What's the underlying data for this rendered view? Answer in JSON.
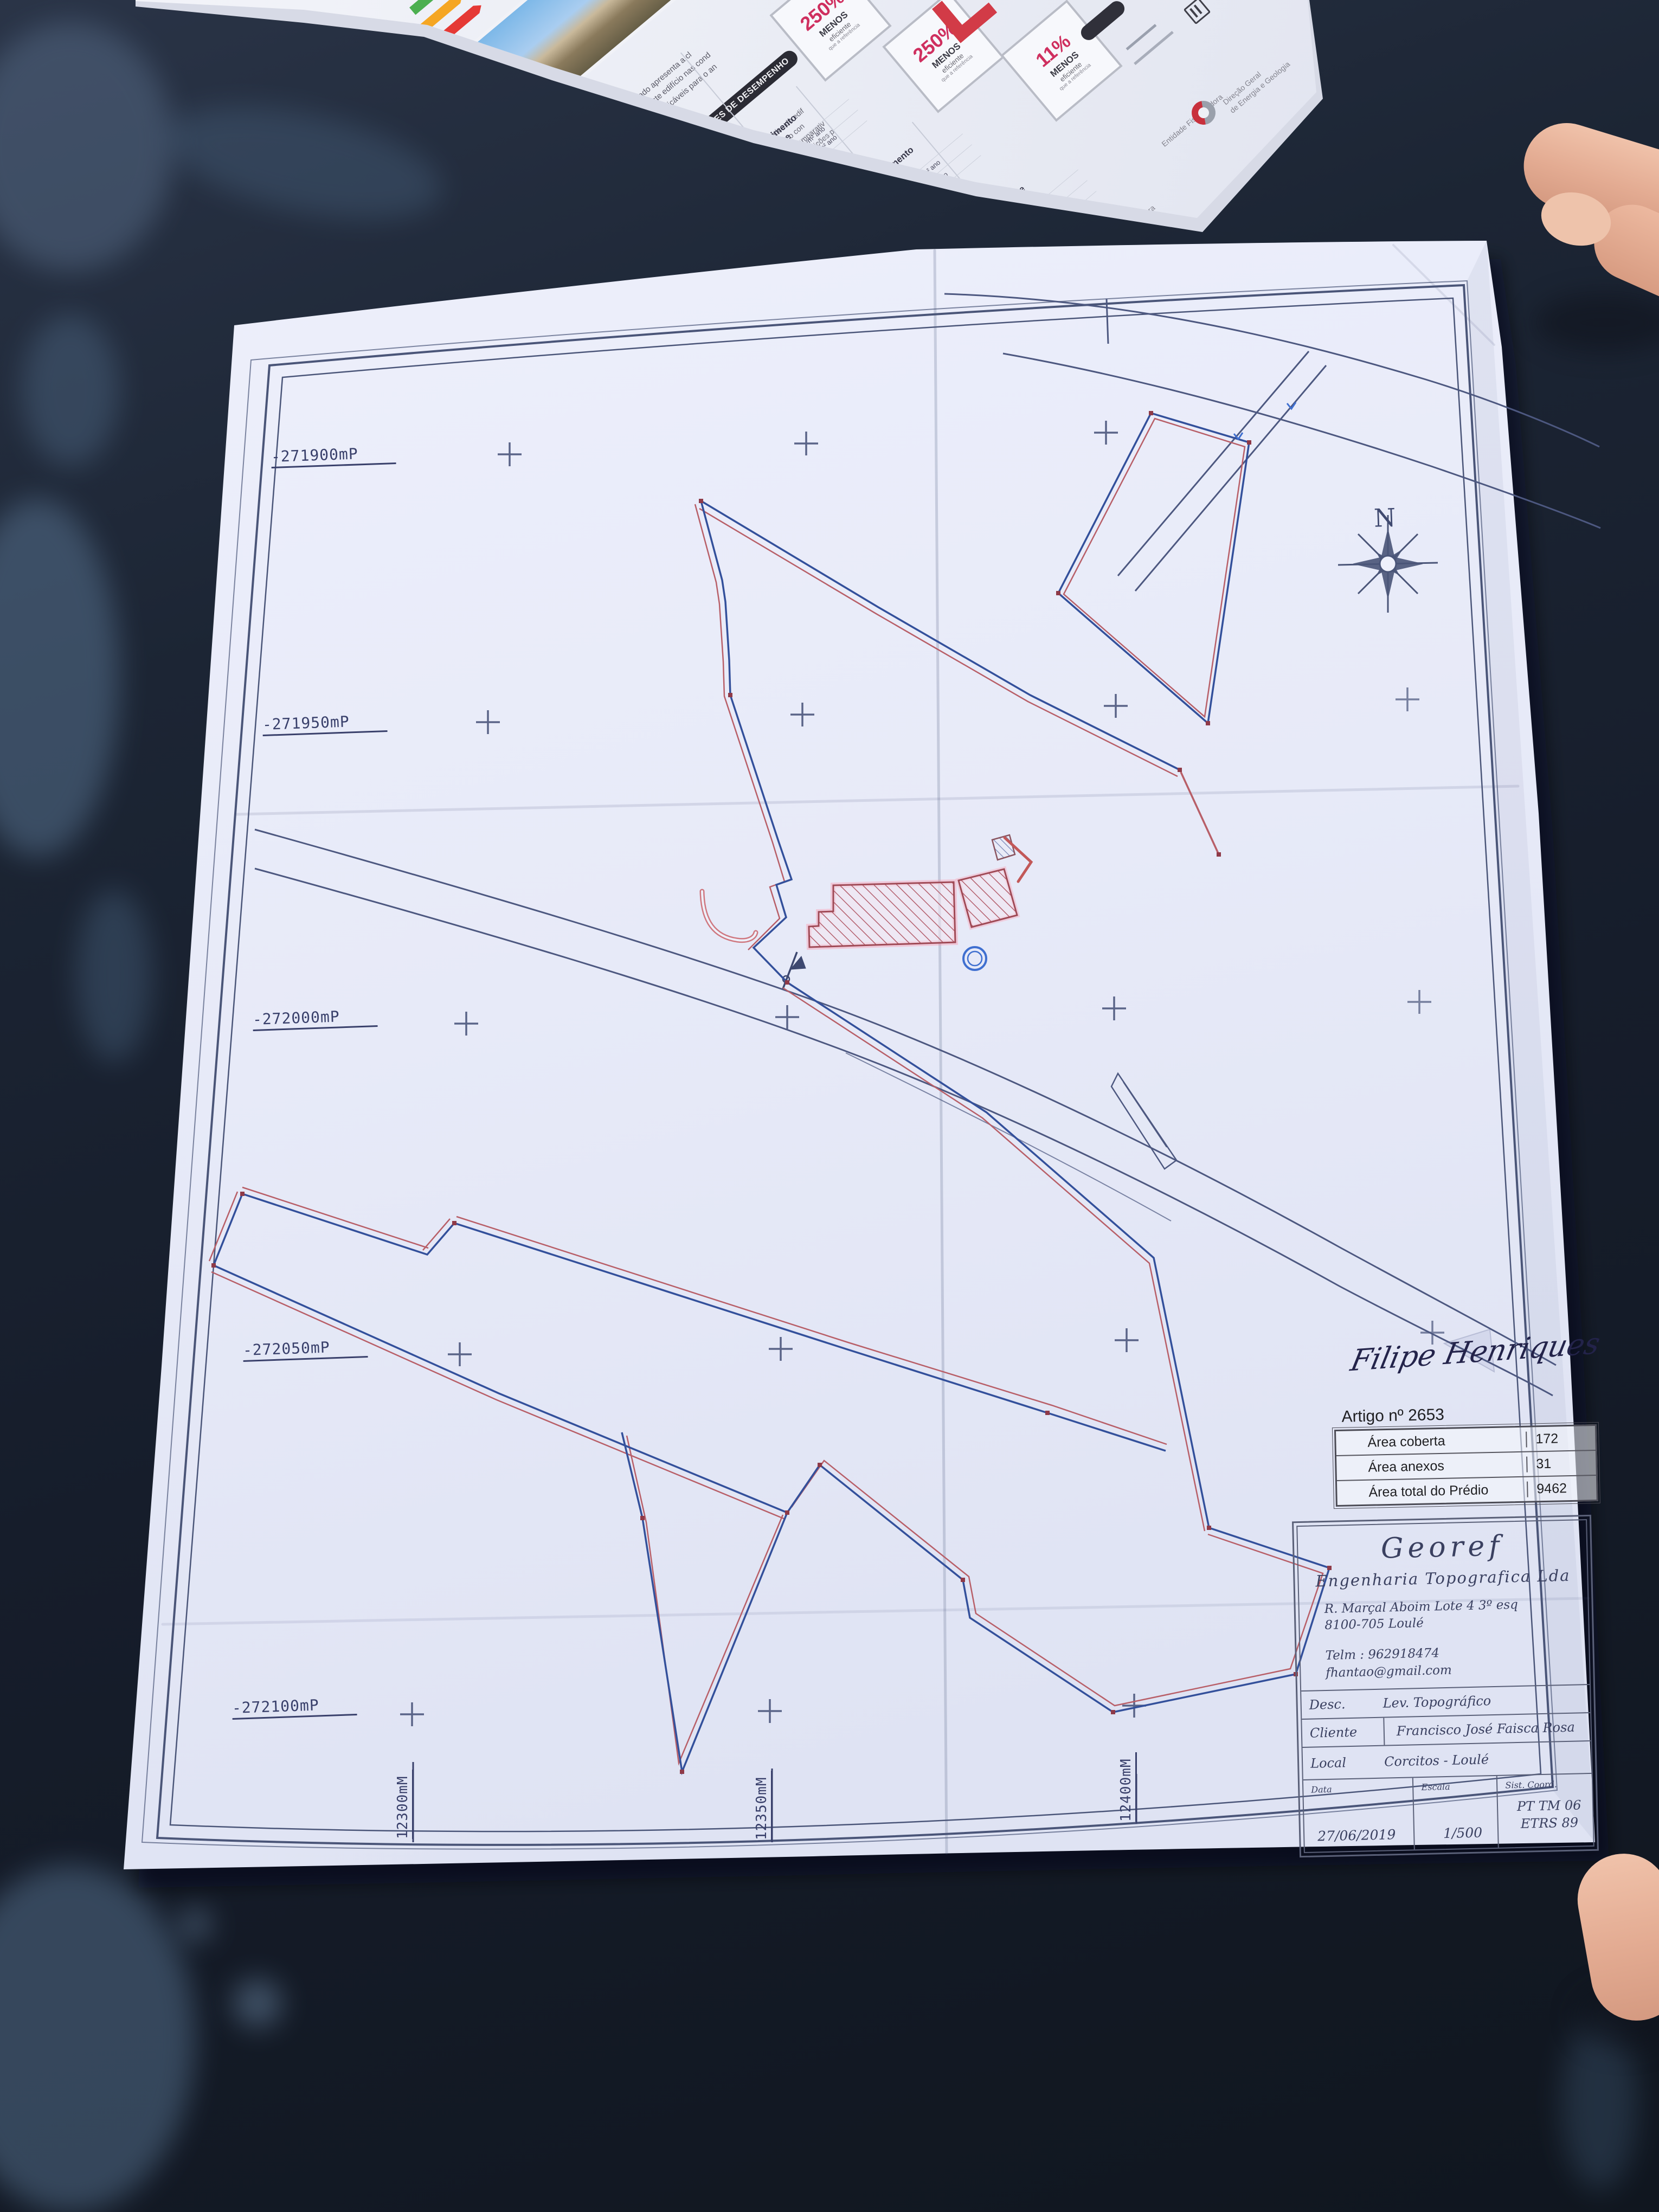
{
  "scene": {
    "table_color": "#141a26",
    "paper_color": "#e9ebf7"
  },
  "brochure": {
    "header": "INDICADORES DE DESEMPENHO",
    "intro_lines": [
      "Este certificado apresenta a cl",
      "energética deste edifício nas cond",
      "ou requisitos aplicáveis para o an"
    ],
    "body_lines": [
      "Determinam a classe energética do edif",
      "utilização de energia, incluindo o con",
      "renováveis. São apresentados comparativ",
      "de referência e calculados em condições p"
    ],
    "sections": [
      {
        "title1": "Aquecimento",
        "title2": "Ambiente",
        "rows": [
          {
            "label": "Referência:",
            "value": "74 kWh/m² ano"
          },
          {
            "label": "Edifício:",
            "value": "291 kWh/m² ano"
          },
          {
            "label": "Renovável:",
            "value": "- %"
          }
        ]
      },
      {
        "title1": "Arrefecimento",
        "title2": "Ambiente",
        "rows": [
          {
            "label": "Referência:",
            "value": "6,3 kWh/m² ano"
          },
          {
            "label": "Edifício:",
            "value": "27 kWh/m² ano"
          },
          {
            "label": "Renovável:",
            "value": "- %"
          }
        ]
      },
      {
        "title1": "Água Quente",
        "title2": "Sanitária",
        "rows": [
          {
            "label": "Referência:",
            "value": "19 kWh/m² ano"
          },
          {
            "label": "Edifício:",
            "value": "21 kWh/m² ano"
          },
          {
            "label": "Renovável:",
            "value": "- %"
          }
        ]
      }
    ],
    "badges": [
      {
        "percent": "250%",
        "l1": "MENOS",
        "l2": "eficiente",
        "l3": "que a referência"
      },
      {
        "percent": "250%",
        "l1": "MENOS",
        "l2": "eficiente",
        "l3": "que a referência"
      },
      {
        "percent": "11%",
        "l1": "MENOS",
        "l2": "eficiente",
        "l3": "que a referência"
      }
    ],
    "fiscal_label": "Entidade Fiscalizadora",
    "fiscal_org1": "Direção Geral",
    "fiscal_org2": "de Energia e Geologia",
    "gestora_label": "Entidade Gestora",
    "adene_name": "adene",
    "adene_sub": "Agência para a Energia",
    "accent_red": "#cf2f5f",
    "accent_blue": "#3f8fd2",
    "accent_orange": "#e07b39"
  },
  "plan": {
    "north_label": "N",
    "left_coords": [
      "-271900mP",
      "-271950mP",
      "-272000mP",
      "-272050mP",
      "-272100mP"
    ],
    "bottom_coords": [
      "12300mM",
      "12350mM",
      "12400mM"
    ],
    "signature": "Filipe Henriques",
    "pen_blue": "#33509b",
    "pen_red": "#b85f68",
    "artigo": {
      "title": "Artigo nº 2653",
      "rows": [
        {
          "label": "Área coberta",
          "value": "172"
        },
        {
          "label": "Área anexos",
          "value": "31"
        },
        {
          "label": "Área total do Prédio",
          "value": "9462"
        }
      ]
    },
    "titleblock": {
      "company": "Georef",
      "company_sub": "Engenharia Topografica Lda",
      "address1": "R. Marçal Aboim Lote 4 3º esq",
      "address2": "8100-705 Loulé",
      "phone": "Telm : 962918474",
      "email": "fhantao@gmail.com",
      "desc_label": "Desc.",
      "desc_value": "Lev. Topográfico",
      "client_label": "Cliente",
      "client_value": "Francisco José Faisca Rosa",
      "local_label": "Local",
      "local_value": "Corcitos - Loulé",
      "date_label": "Data",
      "date_value": "27/06/2019",
      "scale_label": "Escala",
      "scale_value": "1/500",
      "coord_label": "Sist. Coord.",
      "coord_value1": "PT TM 06",
      "coord_value2": "ETRS 89"
    }
  }
}
